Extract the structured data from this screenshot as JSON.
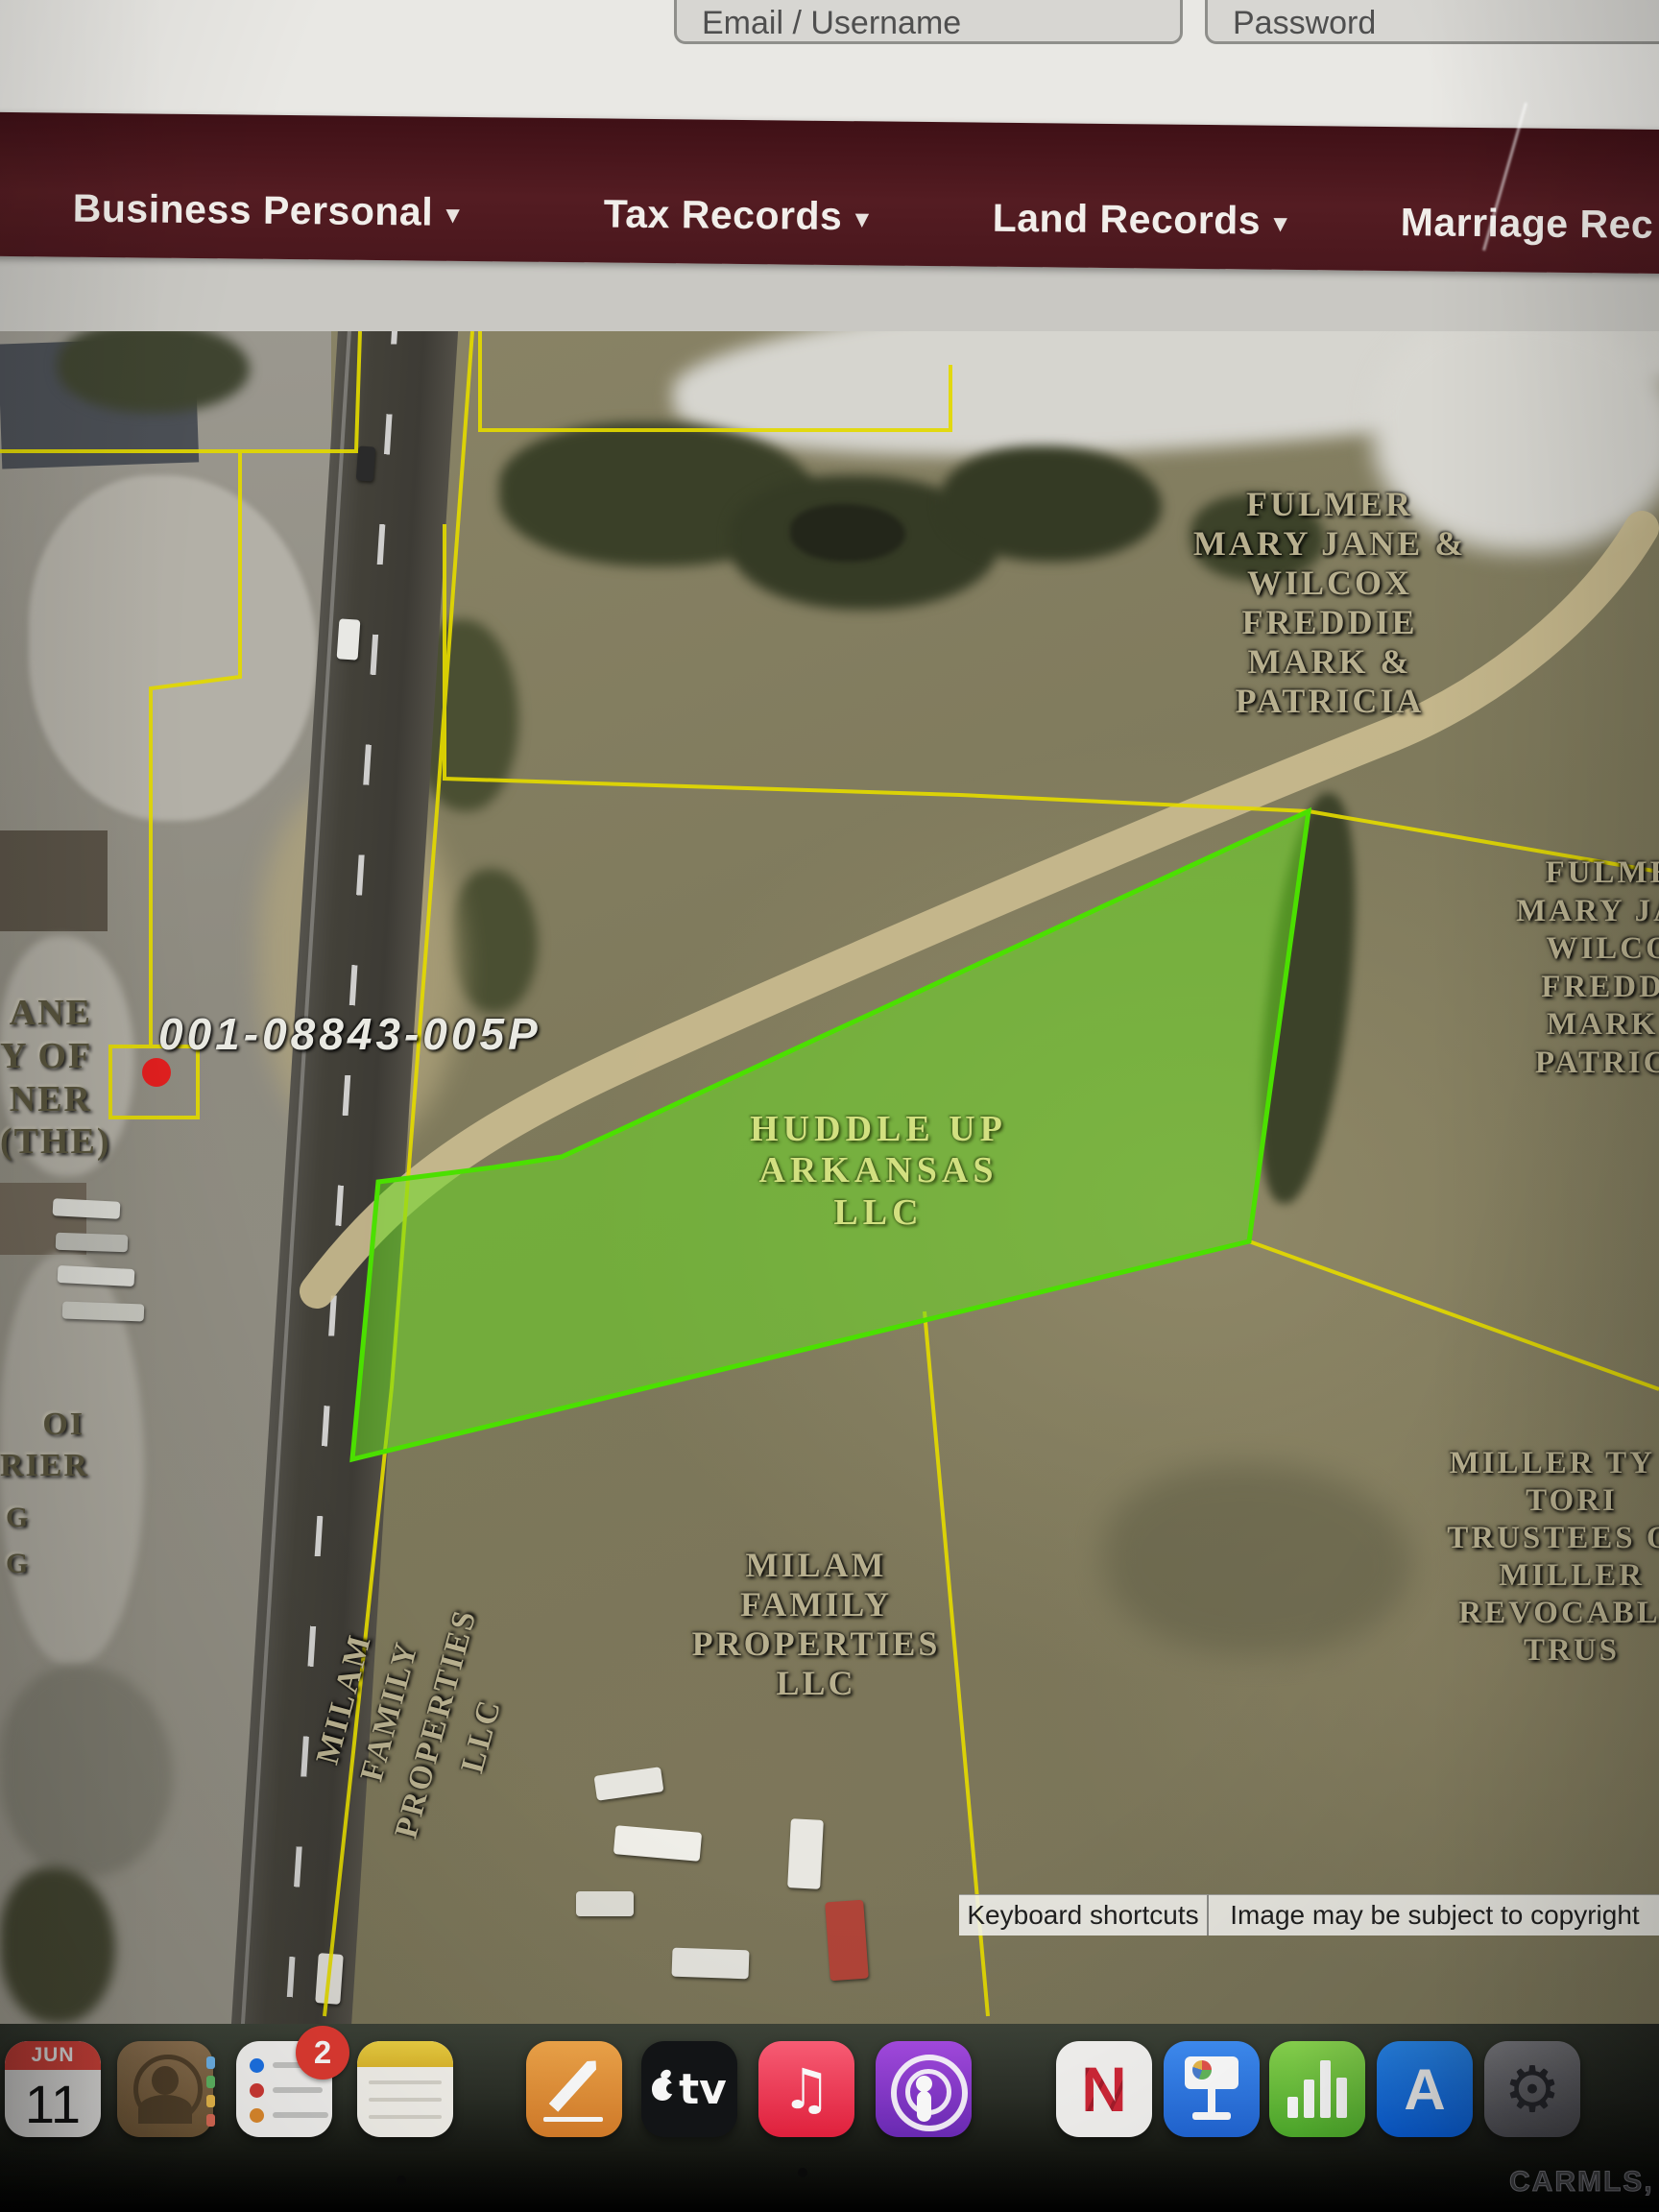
{
  "login": {
    "email_placeholder": "Email / Username",
    "password_placeholder": "Password"
  },
  "navbar": {
    "bg_color": "#541c22",
    "items": [
      {
        "label": "Business Personal",
        "caret": "▾"
      },
      {
        "label": "Tax Records",
        "caret": "▾"
      },
      {
        "label": "Land Records",
        "caret": "▾"
      },
      {
        "label": "Marriage Rec",
        "caret": ""
      }
    ]
  },
  "map": {
    "type": "aerial-parcel-map",
    "selected_parcel_id": "001-08843-005P",
    "highlight_color": "#4be000",
    "parcel_line_color": "#e3d900",
    "labels": {
      "fulmer_main": {
        "lines": [
          "FULMER",
          "MARY JANE &",
          "WILCOX",
          "FREDDIE",
          "MARK &",
          "PATRICIA"
        ]
      },
      "fulmer_edge": {
        "lines": [
          "FULMER",
          "MARY JANE",
          "WILCOX",
          "FREDDIE",
          "MARK &",
          "PATRICIA"
        ]
      },
      "huddle_up": {
        "lines": [
          "HUDDLE UP",
          "ARKANSAS",
          "LLC"
        ]
      },
      "milam_center": {
        "lines": [
          "MILAM",
          "FAMILY",
          "PROPERTIES",
          "LLC"
        ]
      },
      "milam_rotated": {
        "lines": [
          "MILAM",
          "FAMILY",
          "PROPERTIES",
          "LLC"
        ]
      },
      "miller_edge": {
        "lines": [
          "MILLER TY &",
          "TORI",
          "TRUSTEES OF",
          "MILLER",
          "REVOCABLE",
          "TRUS"
        ]
      },
      "left_edge_upper": {
        "lines": [
          "ANE",
          "Y OF",
          "NER",
          "(THE)"
        ]
      },
      "left_edge_lower": {
        "lines": [
          "OI",
          "RIER"
        ]
      },
      "left_edge_g": {
        "lines": [
          "G",
          "G"
        ]
      }
    },
    "attribution": {
      "keyboard_shortcuts": "Keyboard shortcuts",
      "copyright_notice": "Image may be subject to copyright"
    }
  },
  "dock": {
    "calendar": {
      "month": "JUN",
      "day": "11"
    },
    "reminders_badge": "2",
    "apple_tv_label": "tv",
    "news_letter": "N",
    "app_store_letter": "A",
    "settings_glyph": "⚙",
    "music_glyph": "♫",
    "apps": [
      "calendar",
      "contacts",
      "reminders",
      "notes",
      "pages",
      "apple-tv",
      "music",
      "podcasts",
      "news",
      "keynote",
      "numbers",
      "app-store",
      "system-settings"
    ]
  },
  "watermark": "CARMLS, INC"
}
